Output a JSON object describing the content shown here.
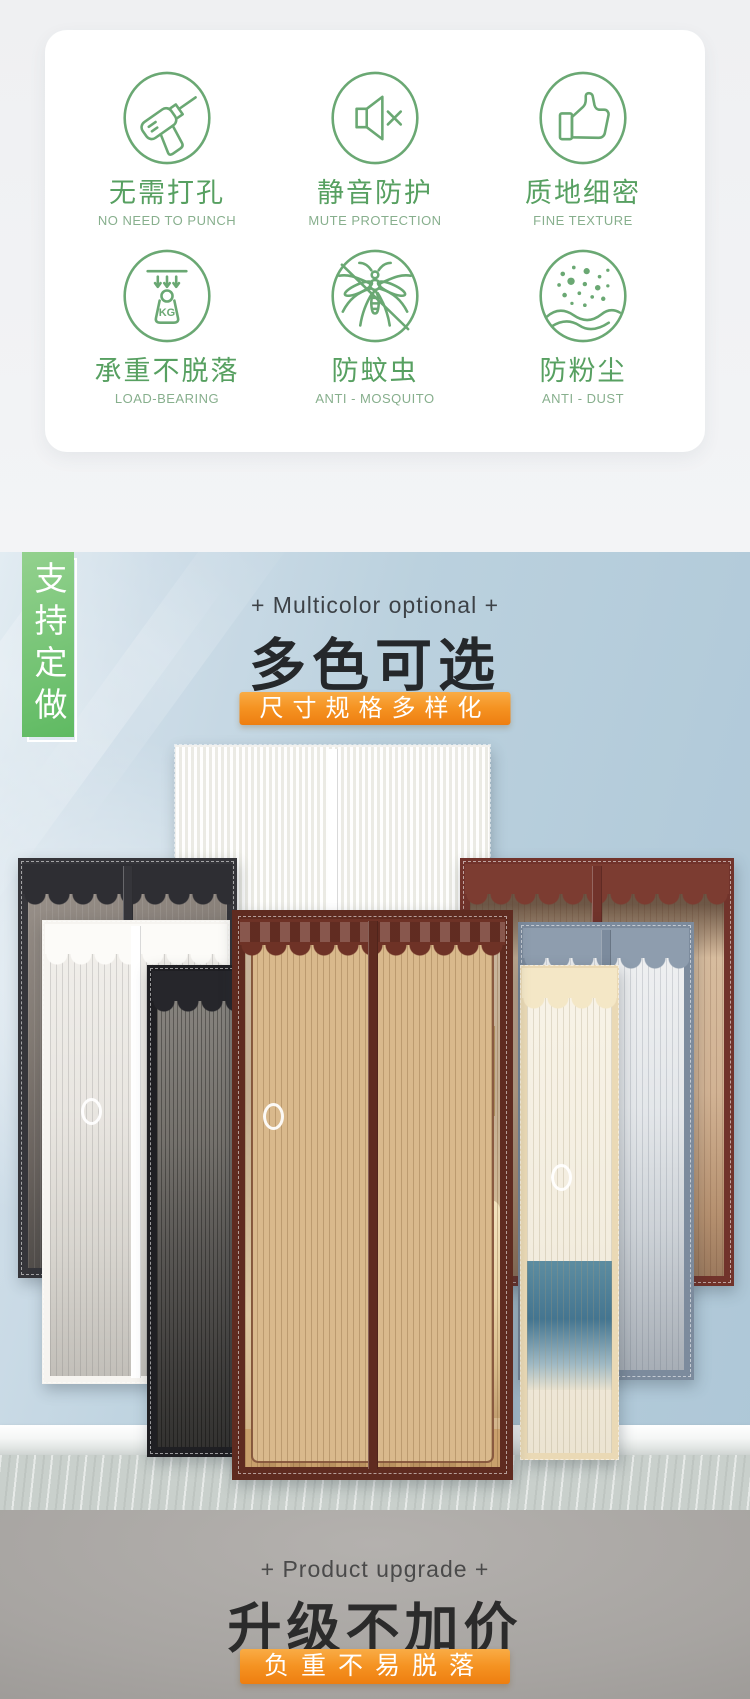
{
  "features": {
    "kg_label": "KG",
    "items": [
      {
        "zh": "无需打孔",
        "en": "NO NEED TO PUNCH",
        "icon": "drill-icon"
      },
      {
        "zh": "静音防护",
        "en": "MUTE PROTECTION",
        "icon": "mute-speaker-icon"
      },
      {
        "zh": "质地细密",
        "en": "FINE TEXTURE",
        "icon": "thumbs-up-icon"
      },
      {
        "zh": "承重不脱落",
        "en": "LOAD-BEARING",
        "icon": "weight-kg-icon"
      },
      {
        "zh": "防蚊虫",
        "en": "ANTI - MOSQUITO",
        "icon": "mosquito-icon"
      },
      {
        "zh": "防粉尘",
        "en": "ANTI - DUST",
        "icon": "dust-icon"
      }
    ]
  },
  "multicolor_section": {
    "side_banner": "支持定做",
    "eyebrow": "+ Multicolor optional +",
    "title": "多色可选",
    "badge": "尺寸规格多样化"
  },
  "upgrade_section": {
    "eyebrow": "+ Product upgrade +",
    "title": "升级不加价",
    "badge": "负重不易脱落"
  },
  "colors": {
    "feature_green": "#6aa873",
    "banner_green": "#6cc26d",
    "badge_orange": "#f59322",
    "wall_blue": "#b3cbda",
    "curtain_colors": [
      "white-lace",
      "charcoal",
      "maroon",
      "white-stripe",
      "gray-blue",
      "black-mesh",
      "cream",
      "brown"
    ]
  }
}
